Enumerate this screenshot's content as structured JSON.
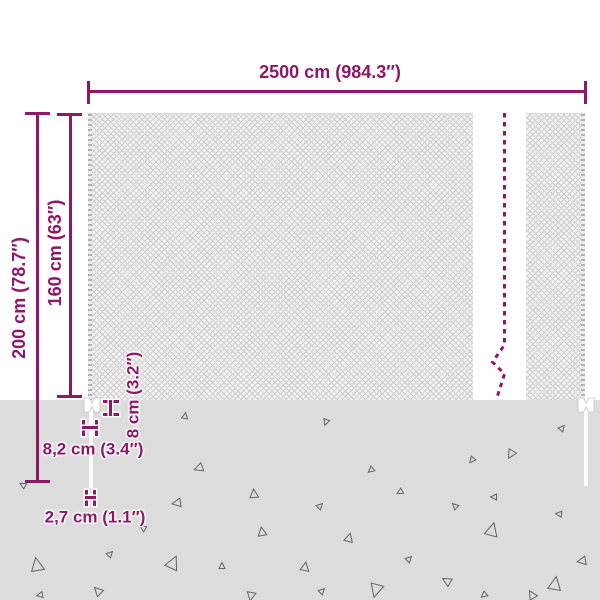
{
  "colors": {
    "accent": "#8e1768",
    "ground": "#dcdcdc",
    "mesh_bg": "#f1f1f1",
    "mesh_line": "#cfcfcf"
  },
  "labels": {
    "total_width": "2500 cm (984.3″)",
    "total_height": "200 cm (78.7″)",
    "net_height": "160 cm (63″)",
    "anchor_depth": "8 cm (3.2″)",
    "anchor_width": "8,2 cm (3.4″)",
    "post_width": "2,7 cm (1.1″)"
  }
}
